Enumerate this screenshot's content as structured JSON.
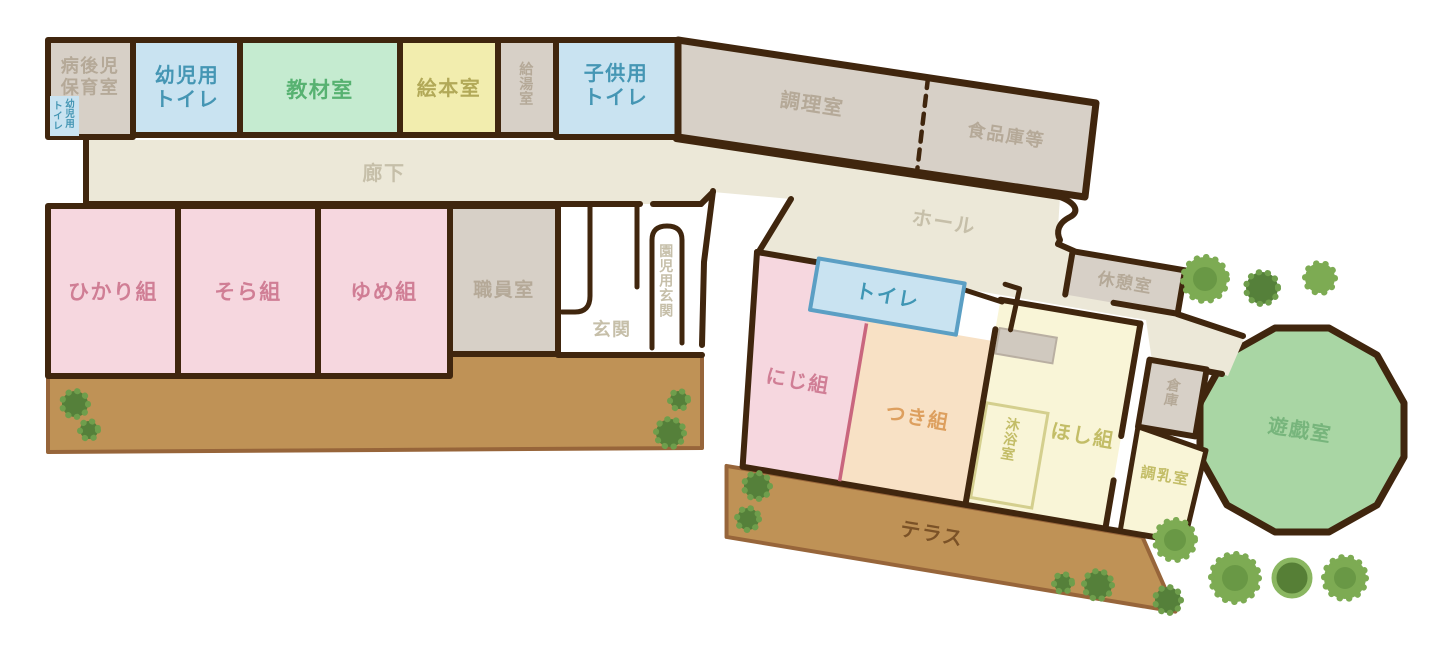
{
  "title": "保育園平面図",
  "colors": {
    "wall": "#40260e",
    "room_gray": "#d7d0c7",
    "room_blue": "#c9e3f1",
    "room_green": "#c5ebd0",
    "room_yellow": "#f2edae",
    "corridor_beige": "#ece8d8",
    "room_pink": "#f6d7df",
    "room_peach": "#f8e1c5",
    "room_pale_yellow": "#f9f5d7",
    "terrace_brown": "#bf9256",
    "playroom_green": "#a9d6a4",
    "tree_green": "#6f9e4c"
  },
  "rooms": {
    "byogoji": {
      "label": "病後児\n保育室"
    },
    "youjiToiletSmall": {
      "col1": "幼児用",
      "col2": "トイレ"
    },
    "youjiToilet": {
      "label": "幼児用\nトイレ"
    },
    "kyozai": {
      "label": "教材室"
    },
    "ehon": {
      "label": "絵本室"
    },
    "kyuto": {
      "label": "給湯室"
    },
    "kodomoToilet": {
      "label": "子供用\nトイレ"
    },
    "chori": {
      "label": "調理室"
    },
    "shokuhinko": {
      "label": "食品庫等"
    },
    "roka": {
      "label": "廊下"
    },
    "hall": {
      "label": "ホール"
    },
    "hikari": {
      "label": "ひかり組"
    },
    "sora": {
      "label": "そら組"
    },
    "yume": {
      "label": "ゆめ組"
    },
    "shokuin": {
      "label": "職員室"
    },
    "genkan": {
      "label": "玄関"
    },
    "enjiGenkan": {
      "label": "園児用玄関"
    },
    "toilet": {
      "label": "トイレ"
    },
    "kyukei": {
      "label": "休憩室"
    },
    "niji": {
      "label": "にじ組"
    },
    "tsuki": {
      "label": "つき組"
    },
    "mokuyoku": {
      "label": "沐浴室"
    },
    "hoshi": {
      "label": "ほし組"
    },
    "soko": {
      "label": "倉庫"
    },
    "chonyu": {
      "label": "調乳室"
    },
    "yugi": {
      "label": "遊戯室"
    },
    "terrace": {
      "label": "テラス"
    }
  }
}
